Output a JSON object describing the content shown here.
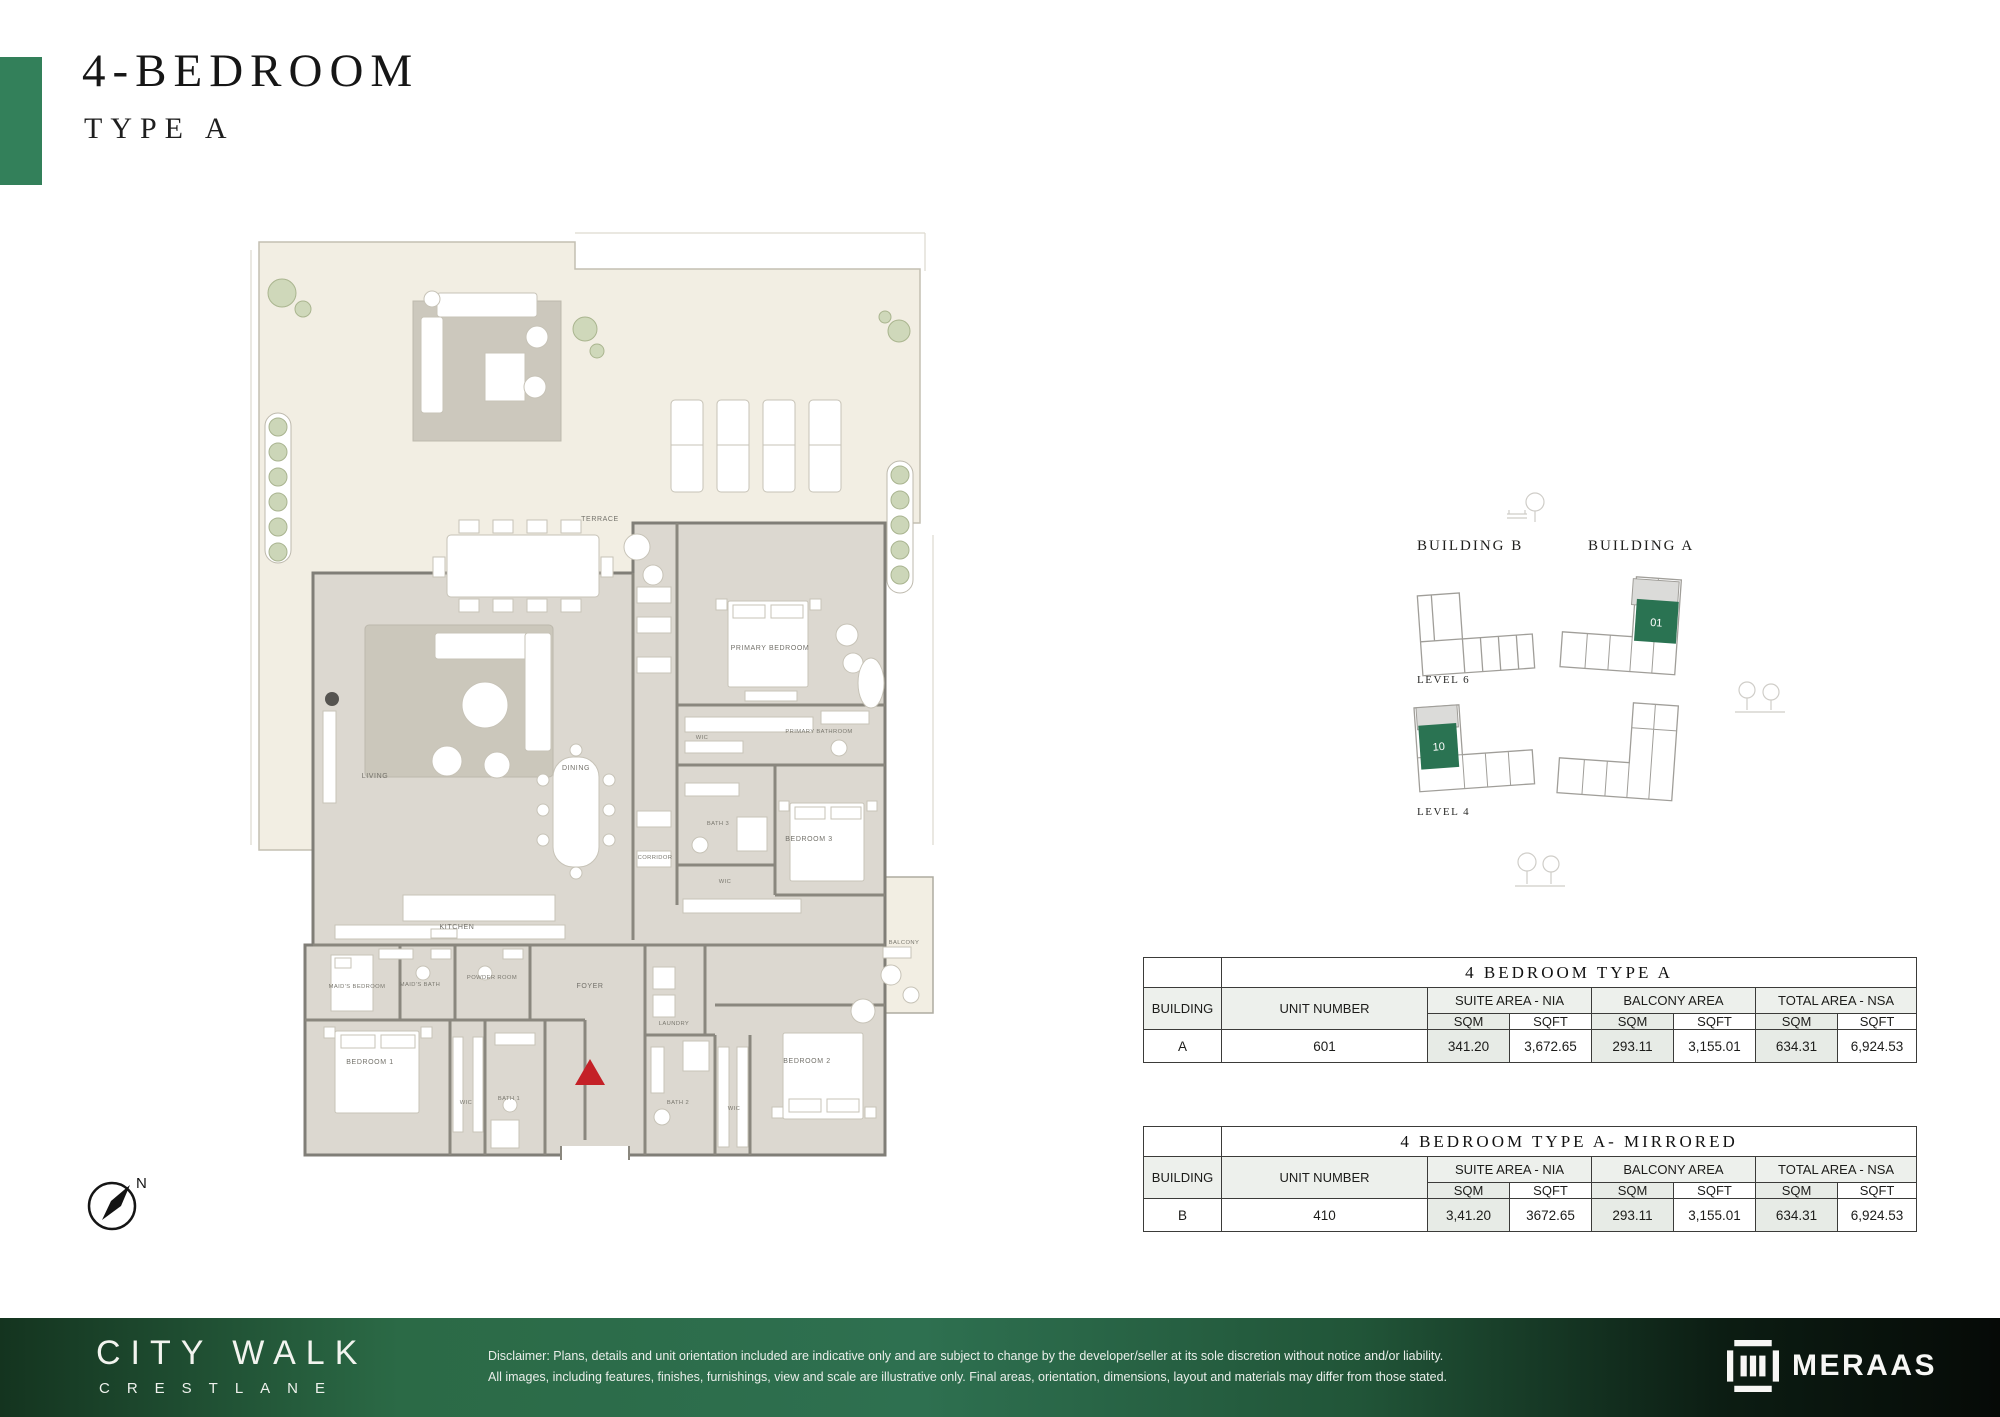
{
  "header": {
    "title": "4-BEDROOM",
    "subtitle": "TYPE A"
  },
  "floorplan": {
    "compass_label": "N",
    "rooms": [
      {
        "label": "TERRACE"
      },
      {
        "label": "LIVING"
      },
      {
        "label": "DINING"
      },
      {
        "label": "KITCHEN"
      },
      {
        "label": "CORRIDOR"
      },
      {
        "label": "PRIMARY BEDROOM"
      },
      {
        "label": "WIC"
      },
      {
        "label": "PRIMARY BATHROOM"
      },
      {
        "label": "BATH 3"
      },
      {
        "label": "BEDROOM 3"
      },
      {
        "label": "WIC"
      },
      {
        "label": "MAID'S BEDROOM"
      },
      {
        "label": "MAID'S BATH"
      },
      {
        "label": "POWDER ROOM"
      },
      {
        "label": "FOYER"
      },
      {
        "label": "LAUNDRY"
      },
      {
        "label": "BEDROOM 1"
      },
      {
        "label": "WIC"
      },
      {
        "label": "BATH 1"
      },
      {
        "label": "BATH 2"
      },
      {
        "label": "WIC"
      },
      {
        "label": "BEDROOM 2"
      },
      {
        "label": "BALCONY"
      }
    ]
  },
  "siteplan": {
    "building_b": "BUILDING B",
    "building_a": "BUILDING A",
    "level6": "LEVEL 6",
    "level4": "LEVEL 4",
    "unit_building_a": "01",
    "unit_building_b": "10"
  },
  "tables": [
    {
      "title": "4 BEDROOM TYPE A",
      "headers": {
        "building": "BUILDING",
        "unit": "UNIT NUMBER",
        "suite": "SUITE AREA - NIA",
        "balcony": "BALCONY AREA",
        "total": "TOTAL AREA - NSA",
        "sqm": "SQM",
        "sqft": "SQFT"
      },
      "row": {
        "building": "A",
        "unit": "601",
        "suite_sqm": "341.20",
        "suite_sqft": "3,672.65",
        "balcony_sqm": "293.11",
        "balcony_sqft": "3,155.01",
        "total_sqm": "634.31",
        "total_sqft": "6,924.53"
      }
    },
    {
      "title": "4 BEDROOM TYPE A- MIRRORED",
      "headers": {
        "building": "BUILDING",
        "unit": "UNIT NUMBER",
        "suite": "SUITE AREA - NIA",
        "balcony": "BALCONY AREA",
        "total": "TOTAL AREA - NSA",
        "sqm": "SQM",
        "sqft": "SQFT"
      },
      "row": {
        "building": "B",
        "unit": "410",
        "suite_sqm": "3,41.20",
        "suite_sqft": "3672.65",
        "balcony_sqm": "293.11",
        "balcony_sqft": "3,155.01",
        "total_sqm": "634.31",
        "total_sqft": "6,924.53"
      }
    }
  ],
  "footer": {
    "brand_line1": "CITY WALK",
    "brand_line2": "CRESTLANE",
    "disclaimer_line1": "Disclaimer: Plans, details and unit orientation included are indicative only and are subject to change by the developer/seller at its sole discretion without notice and/or liability.",
    "disclaimer_line2": "All images, including features, finishes, furnishings, view and scale are illustrative only. Final areas, orientation, dimensions, layout and materials may differ from those stated.",
    "logo_text": "MERAAS"
  },
  "colors": {
    "accent_green": "#33805a",
    "unit_highlight_green": "#2a7352",
    "footer_green": "#2e7050",
    "terrace_cream": "#f2eee3",
    "interior_gray": "#dcd8d0",
    "entrance_red": "#c42127"
  }
}
